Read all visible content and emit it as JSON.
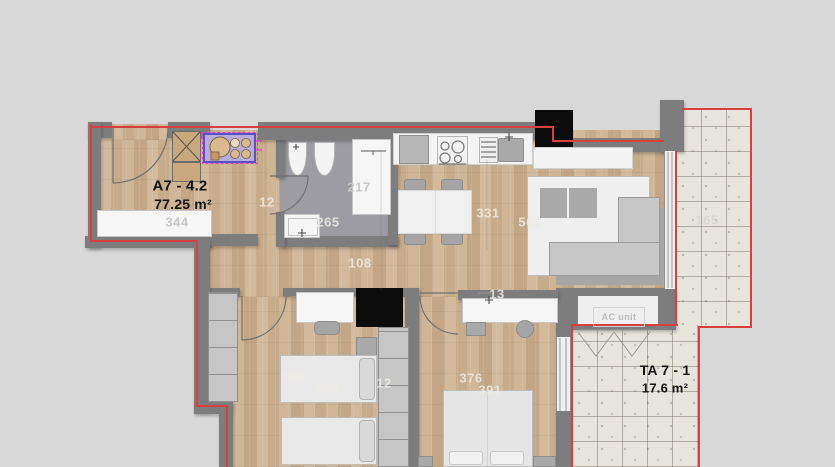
{
  "labels": {
    "unit_name": "A7 - 4.2",
    "unit_area": "77.25 m²",
    "terrace_name": "TA 7 - 1",
    "terrace_area": "17.6 m²",
    "ac_unit": "AC unit"
  },
  "dimensions": [
    {
      "text": "344",
      "x": 177,
      "y": 222,
      "tone": "dark"
    },
    {
      "text": "12",
      "x": 267,
      "y": 202,
      "tone": "light"
    },
    {
      "text": "265",
      "x": 328,
      "y": 222,
      "tone": "light"
    },
    {
      "text": "217",
      "x": 359,
      "y": 187,
      "tone": "dark"
    },
    {
      "text": "108",
      "x": 360,
      "y": 263,
      "tone": "light"
    },
    {
      "text": "331",
      "x": 488,
      "y": 213,
      "tone": "light"
    },
    {
      "text": "561",
      "x": 530,
      "y": 222,
      "tone": "light"
    },
    {
      "text": "355",
      "x": 293,
      "y": 377,
      "tone": "light"
    },
    {
      "text": "398",
      "x": 327,
      "y": 388,
      "tone": "light"
    },
    {
      "text": "12",
      "x": 384,
      "y": 383,
      "tone": "light"
    },
    {
      "text": "13",
      "x": 497,
      "y": 294,
      "tone": "light"
    },
    {
      "text": "376",
      "x": 471,
      "y": 378,
      "tone": "light"
    },
    {
      "text": "391",
      "x": 490,
      "y": 390,
      "tone": "light"
    },
    {
      "text": "165",
      "x": 707,
      "y": 220,
      "tone": "faint"
    }
  ],
  "colors": {
    "outline": "#d84040",
    "wall": "#7d7d7d",
    "wood": "#ccb293",
    "tile": "#e8e5dd",
    "marker": "#0c0c0c",
    "highlight": "#e83bd0",
    "fixture": "#b6addb"
  }
}
